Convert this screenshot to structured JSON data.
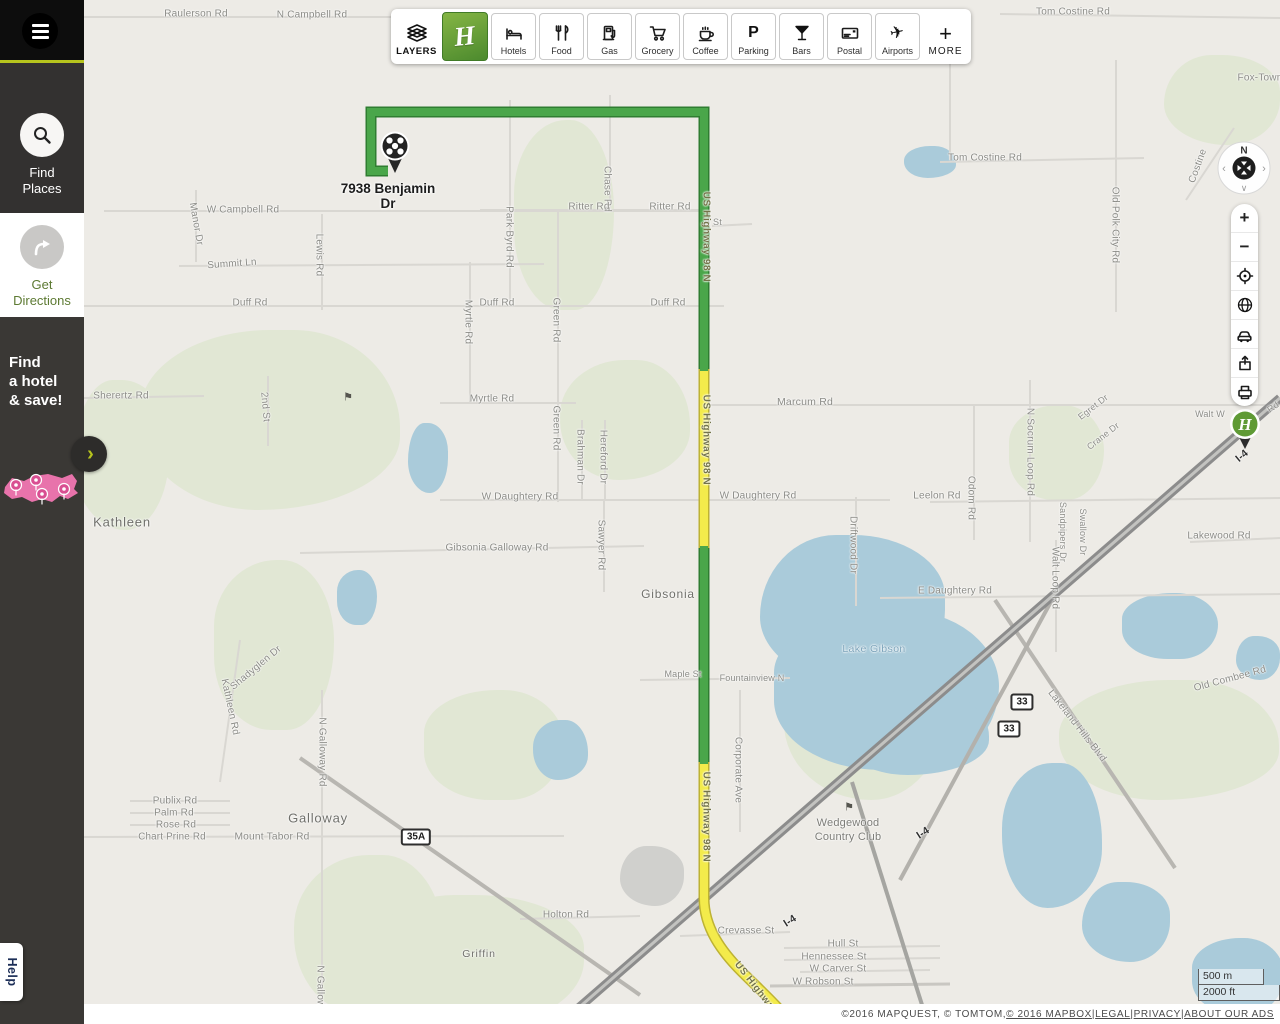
{
  "sidebar": {
    "items": [
      {
        "id": "find-places",
        "label_lines": [
          "Find",
          "Places"
        ],
        "icon": "search-icon",
        "active": true
      },
      {
        "id": "get-directions",
        "label_lines": [
          "Get",
          "Directions"
        ],
        "icon": "directions-arrow-icon",
        "active": false
      }
    ],
    "ad": {
      "lines": [
        "Find",
        "a hotel",
        "& save!"
      ],
      "graphic": "usa-map-with-pins"
    },
    "expand_chevron": "›",
    "help_label": "Help",
    "accent_color": "#b6c41d"
  },
  "toolbar": {
    "layers_label": "LAYERS",
    "brand_letter": "H",
    "more_label": "MORE",
    "buttons": [
      {
        "id": "hotels",
        "label": "Hotels",
        "icon": "hotels-icon"
      },
      {
        "id": "food",
        "label": "Food",
        "icon": "food-icon"
      },
      {
        "id": "gas",
        "label": "Gas",
        "icon": "gas-icon"
      },
      {
        "id": "grocery",
        "label": "Grocery",
        "icon": "grocery-icon"
      },
      {
        "id": "coffee",
        "label": "Coffee",
        "icon": "coffee-icon"
      },
      {
        "id": "parking",
        "label": "Parking",
        "icon": "parking-icon"
      },
      {
        "id": "bars",
        "label": "Bars",
        "icon": "bars-icon"
      },
      {
        "id": "postal",
        "label": "Postal",
        "icon": "postal-icon"
      },
      {
        "id": "airports",
        "label": "Airports",
        "icon": "airports-icon"
      }
    ]
  },
  "map_controls": {
    "compass_n": "N",
    "buttons": [
      {
        "id": "zoom-in",
        "icon": "plus-icon",
        "glyph": "+"
      },
      {
        "id": "zoom-out",
        "icon": "minus-icon",
        "glyph": "−"
      },
      {
        "id": "locate",
        "icon": "locate-icon"
      },
      {
        "id": "satellite",
        "icon": "globe-icon"
      },
      {
        "id": "traffic",
        "icon": "traffic-icon"
      },
      {
        "id": "share",
        "icon": "share-icon"
      },
      {
        "id": "print",
        "icon": "print-icon"
      }
    ]
  },
  "destination": {
    "address_line1": "7938 Benjamin",
    "address_line2": "Dr",
    "marker": "checkered-destination-pin"
  },
  "hotel_marker": {
    "letter": "H",
    "brand": "holiday-inn-pin"
  },
  "scale": {
    "metric": "500 m",
    "imperial": "2000 ft"
  },
  "attribution": {
    "parts": [
      {
        "text": "©2016 MAPQUEST, © TOMTOM, ",
        "link": false
      },
      {
        "text": "© 2016 MAPBOX",
        "link": true
      },
      {
        "text": " | ",
        "link": false
      },
      {
        "text": "LEGAL",
        "link": true
      },
      {
        "text": " | ",
        "link": false
      },
      {
        "text": "PRIVACY",
        "link": true
      },
      {
        "text": " | ",
        "link": false
      },
      {
        "text": "ABOUT OUR ADS",
        "link": true
      }
    ]
  },
  "map": {
    "colors": {
      "bg": "#edebe6",
      "water": "#aacbda",
      "green": "#e1e7d4",
      "route_green": "#4aa64a",
      "route_yellow": "#f3eb4b"
    },
    "greens": [
      [
        56,
        330,
        260,
        180
      ],
      [
        -10,
        380,
        95,
        150
      ],
      [
        130,
        560,
        120,
        170
      ],
      [
        210,
        855,
        150,
        160
      ],
      [
        280,
        895,
        220,
        130
      ],
      [
        430,
        120,
        100,
        190
      ],
      [
        476,
        360,
        130,
        120
      ],
      [
        700,
        630,
        160,
        170
      ],
      [
        925,
        405,
        95,
        95
      ],
      [
        975,
        680,
        220,
        120
      ],
      [
        1080,
        55,
        116,
        90
      ],
      [
        340,
        690,
        140,
        110
      ]
    ],
    "lakes": [
      [
        676,
        535,
        185,
        150,
        "#aacbda"
      ],
      [
        690,
        610,
        225,
        160,
        "#aacbda"
      ],
      [
        755,
        690,
        150,
        85,
        "#aacbda"
      ],
      [
        324,
        423,
        40,
        70,
        "#aacbda"
      ],
      [
        253,
        570,
        40,
        55,
        "#aacbda"
      ],
      [
        449,
        720,
        55,
        60,
        "#aacbda"
      ],
      [
        536,
        846,
        64,
        60,
        "#d0d0cd"
      ],
      [
        1038,
        593,
        96,
        66,
        "#aacbda"
      ],
      [
        918,
        763,
        100,
        145,
        "#aacbda"
      ],
      [
        998,
        882,
        88,
        80,
        "#aacbda"
      ],
      [
        1108,
        938,
        92,
        76,
        "#aacbda"
      ],
      [
        820,
        146,
        52,
        32,
        "#aacbda"
      ],
      [
        1152,
        636,
        44,
        44,
        "#aacbda"
      ]
    ],
    "roads": [
      [
        0,
        17,
        720,
        17,
        2,
        "#d9d7d2"
      ],
      [
        916,
        14,
        1196,
        18,
        2,
        "#d9d7d2"
      ],
      [
        856,
        162,
        1060,
        158,
        2,
        "#d9d7d2"
      ],
      [
        20,
        211,
        620,
        211,
        2,
        "#d9d7d2"
      ],
      [
        95,
        266,
        460,
        264,
        2,
        "#d9d7d2"
      ],
      [
        0,
        306,
        640,
        306,
        2,
        "#d9d7d2"
      ],
      [
        356,
        403,
        492,
        403,
        2,
        "#d9d7d2"
      ],
      [
        616,
        405,
        1196,
        405,
        2,
        "#d9d7d2"
      ],
      [
        0,
        398,
        120,
        396,
        2,
        "#d9d7d2"
      ],
      [
        356,
        500,
        806,
        500,
        2,
        "#d9d7d2"
      ],
      [
        216,
        553,
        560,
        546,
        2,
        "#d9d7d2"
      ],
      [
        796,
        598,
        1196,
        594,
        2,
        "#d9d7d2"
      ],
      [
        556,
        680,
        706,
        678,
        2,
        "#d9d7d2"
      ],
      [
        0,
        837,
        480,
        836,
        2,
        "#d9d7d2"
      ],
      [
        46,
        801,
        146,
        801,
        2,
        "#d9d7d2"
      ],
      [
        46,
        813,
        146,
        813,
        2,
        "#d9d7d2"
      ],
      [
        46,
        825,
        146,
        825,
        2,
        "#d9d7d2"
      ],
      [
        436,
        919,
        556,
        916,
        2,
        "#d9d7d2"
      ],
      [
        596,
        936,
        706,
        932,
        2,
        "#d9d7d2"
      ],
      [
        700,
        948,
        856,
        946,
        2,
        "#d9d7d2"
      ],
      [
        700,
        960,
        856,
        958,
        2,
        "#d9d7d2"
      ],
      [
        716,
        972,
        846,
        970,
        2,
        "#d9d7d2"
      ],
      [
        686,
        986,
        866,
        984,
        3,
        "#c9c7c2"
      ],
      [
        1106,
        542,
        1196,
        538,
        2,
        "#d9d7d2"
      ],
      [
        846,
        502,
        1196,
        498,
        2,
        "#d9d7d2"
      ],
      [
        628,
        226,
        668,
        224,
        2,
        "#d9d7d2"
      ],
      [
        396,
        210,
        616,
        210,
        2,
        "#d9d7d2"
      ],
      [
        112,
        190,
        112,
        262,
        2,
        "#d9d7d2"
      ],
      [
        238,
        214,
        238,
        310,
        2,
        "#d9d7d2"
      ],
      [
        184,
        376,
        184,
        446,
        2,
        "#d9d7d2"
      ],
      [
        426,
        100,
        426,
        306,
        2,
        "#d9d7d2"
      ],
      [
        526,
        95,
        526,
        211,
        2,
        "#d9d7d2"
      ],
      [
        386,
        262,
        386,
        403,
        2,
        "#d9d7d2"
      ],
      [
        474,
        211,
        474,
        502,
        2,
        "#d9d7d2"
      ],
      [
        498,
        420,
        498,
        500,
        2,
        "#d9d7d2"
      ],
      [
        521,
        420,
        521,
        500,
        2,
        "#d9d7d2"
      ],
      [
        520,
        500,
        520,
        592,
        2,
        "#d9d7d2"
      ],
      [
        772,
        497,
        772,
        606,
        2,
        "#d9d7d2"
      ],
      [
        890,
        405,
        890,
        540,
        2,
        "#d9d7d2"
      ],
      [
        946,
        380,
        946,
        542,
        2,
        "#d9d7d2"
      ],
      [
        972,
        540,
        972,
        652,
        2,
        "#d9d7d2"
      ],
      [
        1032,
        60,
        1032,
        312,
        2,
        "#d9d7d2"
      ],
      [
        238,
        690,
        238,
        1024,
        2,
        "#d9d7d2"
      ],
      [
        656,
        690,
        656,
        832,
        2,
        "#d9d7d2"
      ],
      [
        156,
        640,
        136,
        782,
        2,
        "#d9d7d2"
      ],
      [
        1102,
        200,
        1150,
        128,
        2,
        "#d9d7d2"
      ],
      [
        866,
        60,
        866,
        160,
        2,
        "#d9d7d2"
      ],
      [
        216,
        758,
        556,
        995,
        4,
        "#b8b6b1"
      ],
      [
        911,
        600,
        1091,
        868,
        4,
        "#b8b6b1"
      ],
      [
        816,
        880,
        976,
        585,
        4,
        "#b3b1ac"
      ],
      [
        768,
        782,
        844,
        1024,
        4,
        "#a5a5a1"
      ],
      [
        476,
        1024,
        1196,
        398,
        9,
        "#8c8c8c"
      ],
      [
        476,
        1024,
        1196,
        398,
        3,
        "#c3c3c0"
      ]
    ],
    "route": {
      "green_d": "M304 171 L287 171 L287 112 L620 112 L620 371 M620 546 L620 764",
      "yellow_d": "M620 369 L620 548 M620 762 L620 898 C620 928 638 952 658 972 C678 992 696 1008 707 1024",
      "green": "#4aa64a",
      "green_casing": "#2f7d31",
      "yellow": "#f3eb4b",
      "yellow_casing": "#bdb233",
      "width": 8
    },
    "labels": [
      [
        "Raulerson Rd",
        112,
        14
      ],
      [
        "N Campbell Rd",
        228,
        15
      ],
      [
        "Britt Rd N",
        334,
        58,
        0,
        "",
        9
      ],
      [
        "W Socrum Loop Rd",
        716,
        58
      ],
      [
        "E Padgett Rd",
        840,
        57
      ],
      [
        "Tom Costine Rd",
        989,
        12
      ],
      [
        "Tom Costine Rd",
        901,
        158
      ],
      [
        "Fox-Town",
        1176,
        78
      ],
      [
        "Costine",
        1114,
        166,
        -70
      ],
      [
        "Old Polk City Rd",
        1031,
        225,
        90
      ],
      [
        "W Campbell Rd",
        159,
        210
      ],
      [
        "Manor Dr",
        112,
        224,
        80
      ],
      [
        "Summit Ln",
        148,
        264,
        -4
      ],
      [
        "Lewis Rd",
        235,
        255,
        90
      ],
      [
        "Duff Rd",
        166,
        303
      ],
      [
        "Duff Rd",
        413,
        303
      ],
      [
        "Duff Rd",
        584,
        303
      ],
      [
        "Park Byrd Rd",
        425,
        237,
        90
      ],
      [
        "Chase Rd",
        523,
        189,
        90
      ],
      [
        "Ritter Rd",
        505,
        207
      ],
      [
        "Ritter Rd",
        586,
        207
      ],
      [
        "B St",
        629,
        222,
        0,
        "",
        9
      ],
      [
        "Myrtle Rd",
        384,
        322,
        90
      ],
      [
        "Myrtle Rd",
        408,
        399
      ],
      [
        "Green Rd",
        472,
        320,
        90
      ],
      [
        "Green Rd",
        472,
        428,
        90
      ],
      [
        "Sherertz Rd",
        37,
        396
      ],
      [
        "2nd St",
        181,
        407,
        85
      ],
      [
        "Kathleen",
        38,
        522,
        0,
        "town",
        13
      ],
      [
        "Marcum Rd",
        721,
        402,
        0,
        "",
        10.5
      ],
      [
        "Brahman Dr",
        496,
        457,
        90
      ],
      [
        "Hereford Dr",
        519,
        457,
        90
      ],
      [
        "W Daughtery Rd",
        436,
        497
      ],
      [
        "W Daughtery Rd",
        674,
        496
      ],
      [
        "Leelon Rd",
        853,
        496
      ],
      [
        "Odom Rd",
        887,
        498,
        90
      ],
      [
        "N Socrum Loop Rd",
        946,
        452,
        90
      ],
      [
        "Egret Dr",
        1009,
        407,
        -38,
        "",
        9
      ],
      [
        "Crane Dr",
        1019,
        436,
        -38,
        "",
        9
      ],
      [
        "Sandpipers Dr",
        979,
        532,
        90,
        "",
        9
      ],
      [
        "Swallow Dr",
        999,
        532,
        90,
        "",
        9
      ],
      [
        "Walt Loop Rd",
        971,
        578,
        90
      ],
      [
        "Lakewood Rd",
        1135,
        536
      ],
      [
        "Walt W",
        1126,
        414,
        0,
        "",
        9
      ],
      [
        "Rd",
        1189,
        407,
        -35,
        "",
        9
      ],
      [
        "Gibsonia Galloway Rd",
        413,
        548
      ],
      [
        "Sawyer Rd",
        517,
        545,
        90
      ],
      [
        "Gibsonia",
        584,
        594,
        0,
        "town",
        12
      ],
      [
        "Lake Gibson",
        790,
        649,
        0,
        "water"
      ],
      [
        "E Daughtery Rd",
        871,
        591
      ],
      [
        "Driftwood Dr",
        769,
        545,
        90
      ],
      [
        "Maple St",
        599,
        674,
        0,
        "",
        9
      ],
      [
        "Fountainview N",
        668,
        678,
        0,
        "",
        9
      ],
      [
        "Corporate Ave",
        654,
        770,
        90
      ],
      [
        "Old Combee Rd",
        1146,
        679,
        -15
      ],
      [
        "Lakeland Hills Blvd",
        993,
        726,
        52
      ],
      [
        "Wedgewood",
        764,
        823,
        0,
        "big"
      ],
      [
        "Country Club",
        764,
        837,
        0,
        "big"
      ],
      [
        "Shadyglen Dr",
        172,
        668,
        -40
      ],
      [
        "Kathleen Rd",
        146,
        707,
        78
      ],
      [
        "N Galloway Rd",
        238,
        752,
        90
      ],
      [
        "N Galloway Rd",
        236,
        1000,
        90
      ],
      [
        "Publix Rd",
        91,
        801
      ],
      [
        "Palm Rd",
        90,
        813
      ],
      [
        "Rose Rd",
        92,
        825
      ],
      [
        "Chart Prine Rd",
        88,
        837,
        0,
        "",
        9.8
      ],
      [
        "Mount Tabor Rd",
        188,
        837,
        0,
        "",
        10.2
      ],
      [
        "Galloway",
        234,
        818,
        0,
        "town",
        13
      ],
      [
        "Griffin",
        395,
        954,
        0,
        "town",
        10.5
      ],
      [
        "Holton Rd",
        482,
        915
      ],
      [
        "Crevasse St",
        662,
        931
      ],
      [
        "Hull St",
        759,
        944
      ],
      [
        "Hennessee St",
        750,
        957
      ],
      [
        "W Carver St",
        754,
        969
      ],
      [
        "W Robson St",
        739,
        982,
        0,
        "",
        10
      ],
      [
        "US Highway 98 N",
        622,
        237,
        90,
        "route"
      ],
      [
        "US Highway 98 N",
        622,
        440,
        90,
        "route"
      ],
      [
        "US Highway 98 N",
        622,
        817,
        90,
        "route"
      ],
      [
        "US Highway",
        672,
        988,
        52,
        "route"
      ],
      [
        "I-4",
        839,
        833,
        -33,
        "hwy"
      ],
      [
        "I-4",
        706,
        921,
        -33,
        "hwy"
      ],
      [
        "I-4",
        1158,
        456,
        -40,
        "hwy"
      ]
    ],
    "shields": [
      [
        "35A",
        332,
        837
      ],
      [
        "33",
        938,
        702
      ],
      [
        "33",
        925,
        729
      ]
    ],
    "golf_flags": [
      [
        264,
        397
      ],
      [
        765,
        807
      ]
    ]
  }
}
